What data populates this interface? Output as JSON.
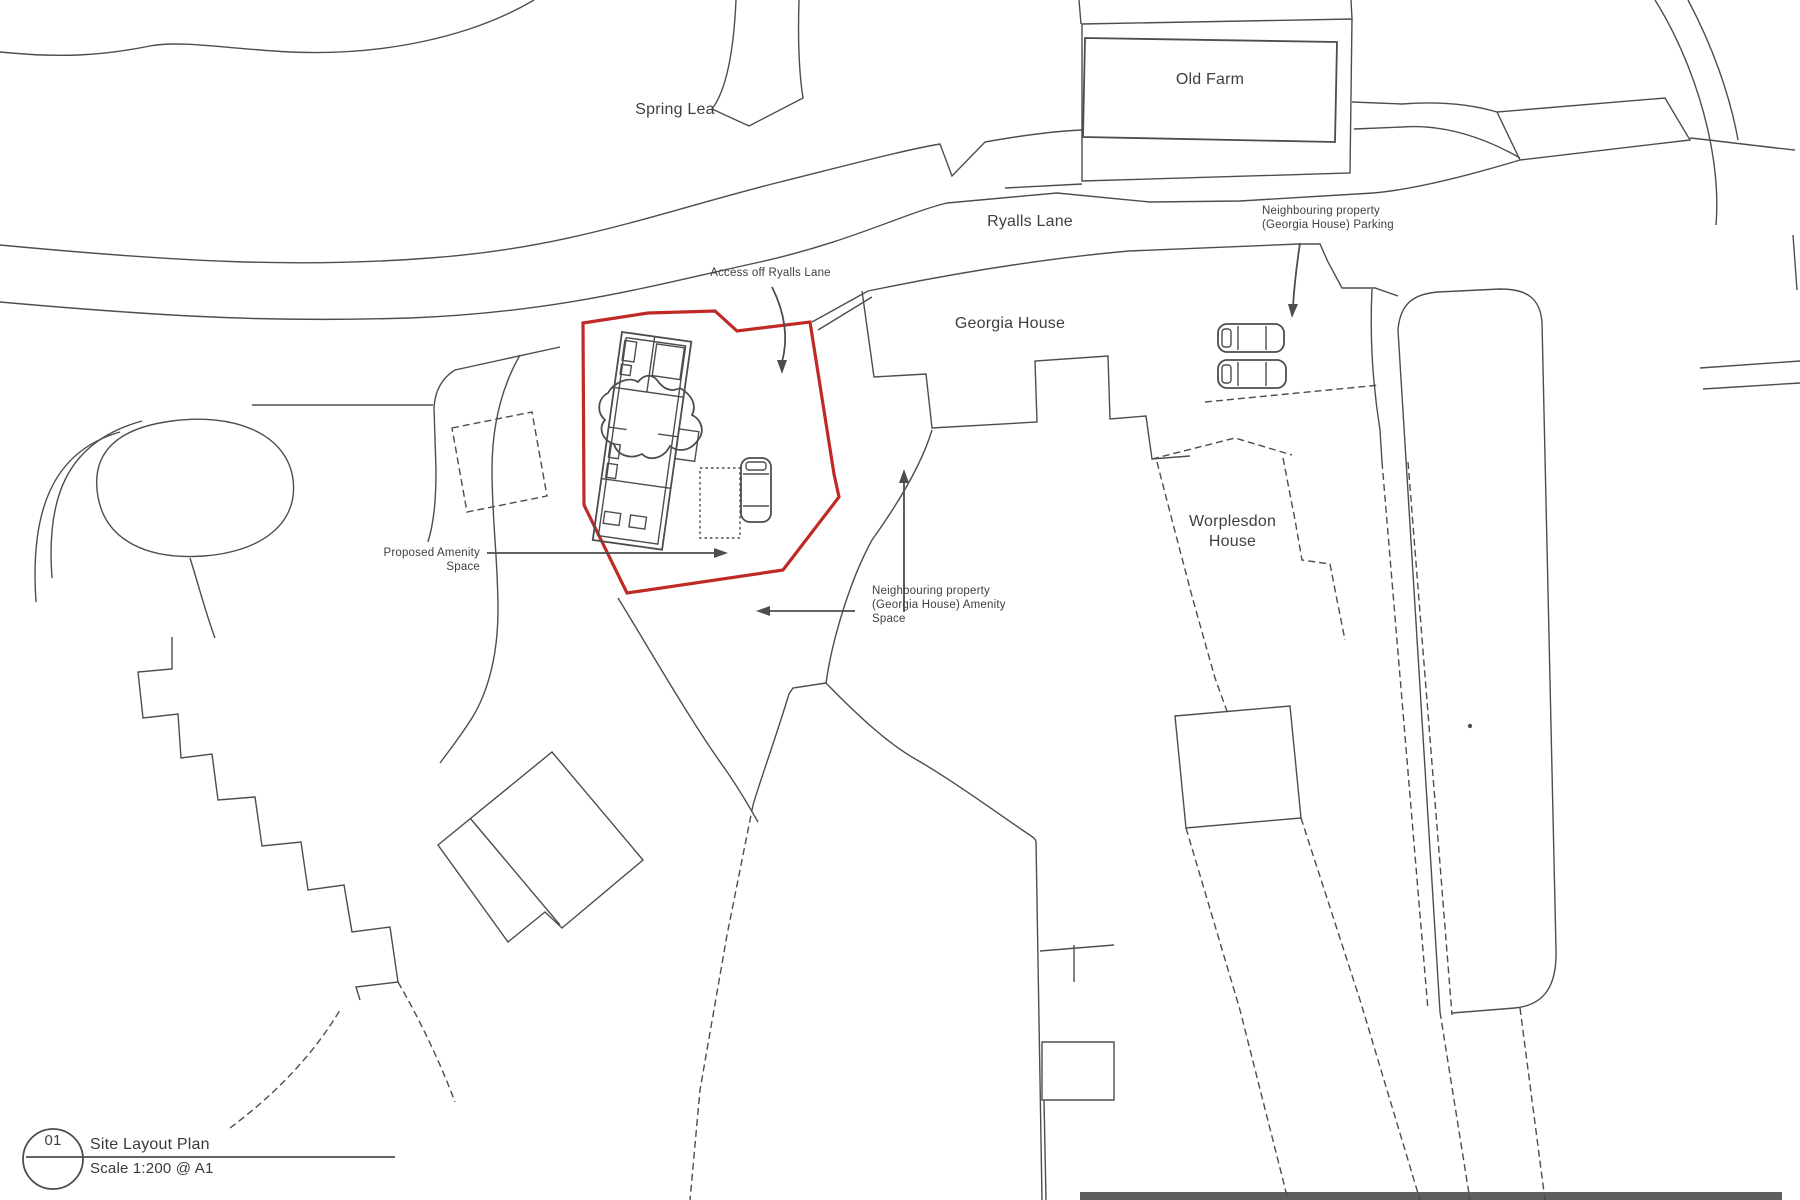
{
  "labels": {
    "spring_lea": "Spring Lea",
    "old_farm": "Old Farm",
    "ryalls_lane": "Ryalls Lane",
    "neighbouring_parking": "Neighbouring property\n(Georgia House) Parking",
    "access_off_ryalls_lane": "Access off Ryalls Lane",
    "georgia_house": "Georgia House",
    "worplesdon_house": "Worplesdon\nHouse",
    "proposed_amenity": "Proposed Amenity\nSpace",
    "neighbouring_amenity": "Neighbouring property\n(Georgia House) Amenity\nSpace"
  },
  "title_block": {
    "number": "01",
    "title": "Site Layout Plan",
    "scale": "Scale 1:200 @ A1"
  },
  "colors": {
    "paper": "#ffffff",
    "ink": "#4d4d4d",
    "label": "#3f3f3f",
    "site_boundary": "#bf2a26",
    "scan_bar": "#494949"
  }
}
